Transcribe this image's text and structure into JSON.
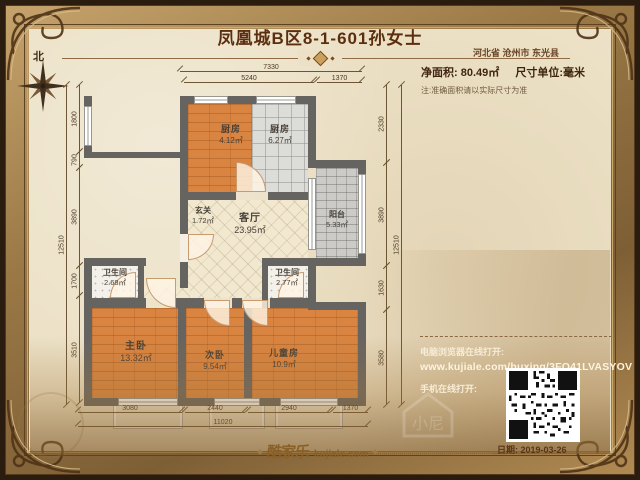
{
  "header": {
    "title": "凤凰城B区8-1-601孙女士",
    "location": "河北省 沧州市 东光县",
    "net_area_label": "净面积:",
    "net_area_value": "80.49㎡",
    "dim_unit_label": "尺寸单位:毫米",
    "note": "注:准确面积请以实际尺寸为准",
    "compass": "北"
  },
  "rooms": [
    {
      "name": "厨房",
      "area": "4.12㎡"
    },
    {
      "name": "厨房",
      "area": "6.27㎡"
    },
    {
      "name": "玄关",
      "area": "1.72㎡"
    },
    {
      "name": "客厅",
      "area": "23.95㎡"
    },
    {
      "name": "阳台",
      "area": "5.33㎡"
    },
    {
      "name": "卫生间",
      "area": "2.68㎡"
    },
    {
      "name": "卫生间",
      "area": "2.77㎡"
    },
    {
      "name": "主卧",
      "area": "13.32㎡"
    },
    {
      "name": "次卧",
      "area": "9.54㎡"
    },
    {
      "name": "儿童房",
      "area": "10.9㎡"
    }
  ],
  "dims": {
    "top": [
      "7330",
      "5240",
      "1370"
    ],
    "bottom": [
      "3080",
      "2440",
      "2940",
      "1370",
      "11020"
    ],
    "left": [
      "1800",
      "790",
      "3890",
      "1700",
      "3510",
      "12510"
    ],
    "right": [
      "2330",
      "3890",
      "1630",
      "3580",
      "12510"
    ]
  },
  "footer": {
    "pc_label": "电脑浏览器在线打开:",
    "url": "www.kujiale.com/huxing/3FO41LVASYOV",
    "mobile_label": "手机在线打开:",
    "brand": "酷家乐",
    "brand_domain": "kujiale.com",
    "date": "日期: 2019-03-26",
    "watermark": "小尼"
  },
  "colors": {
    "frame_gold": "#9a7946",
    "parchment": "#ece1c6",
    "wall_gray": "#666461",
    "wood_orange": "#d98440",
    "title_brown": "#5c2e10"
  }
}
